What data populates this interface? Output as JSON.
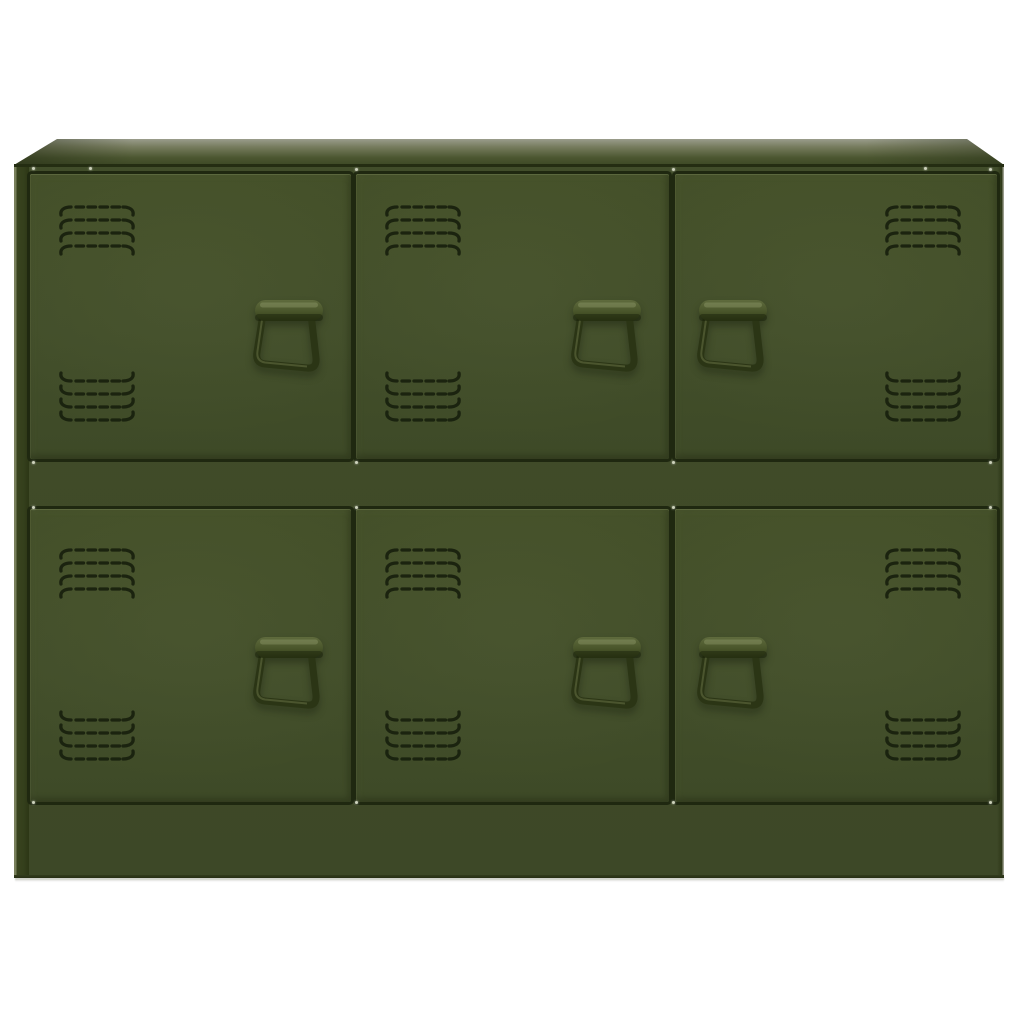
{
  "scene": {
    "type": "product-photo",
    "subject": "Olive green steel storage sideboard with six ventilated locker-style doors",
    "background_color": "#ffffff",
    "visible_text": "none"
  },
  "palette": {
    "body_olive": "#3f4a28",
    "door_olive": "#424e2a",
    "top_surface_light": "#9a9d8c",
    "top_surface_dark": "#3e4926",
    "gap_shadow": "#1f2810",
    "vent_slot": "#19210e",
    "handle_wire": "#2b3515",
    "handle_highlight": "#5f6b3d",
    "rivet_light": "#cdd2bb",
    "floor_shadow": "rgba(50,55,40,0.28)"
  },
  "cabinet": {
    "rows": 2,
    "columns": 3,
    "door_count": 6,
    "vent_groups_per_door": 2,
    "vent_rows_per_group": 4,
    "vent_dashes_per_row": 4,
    "handle_style": "fold-down locker pull",
    "doors": [
      {
        "id": "top-left",
        "row": 1,
        "col": 1,
        "vents_side": "left",
        "handle_side": "right"
      },
      {
        "id": "top-middle",
        "row": 1,
        "col": 2,
        "vents_side": "left",
        "handle_side": "right"
      },
      {
        "id": "top-right",
        "row": 1,
        "col": 3,
        "vents_side": "right",
        "handle_side": "left"
      },
      {
        "id": "bottom-left",
        "row": 2,
        "col": 1,
        "vents_side": "left",
        "handle_side": "right"
      },
      {
        "id": "bottom-middle",
        "row": 2,
        "col": 2,
        "vents_side": "left",
        "handle_side": "right"
      },
      {
        "id": "bottom-right",
        "row": 2,
        "col": 3,
        "vents_side": "right",
        "handle_side": "left"
      }
    ]
  }
}
